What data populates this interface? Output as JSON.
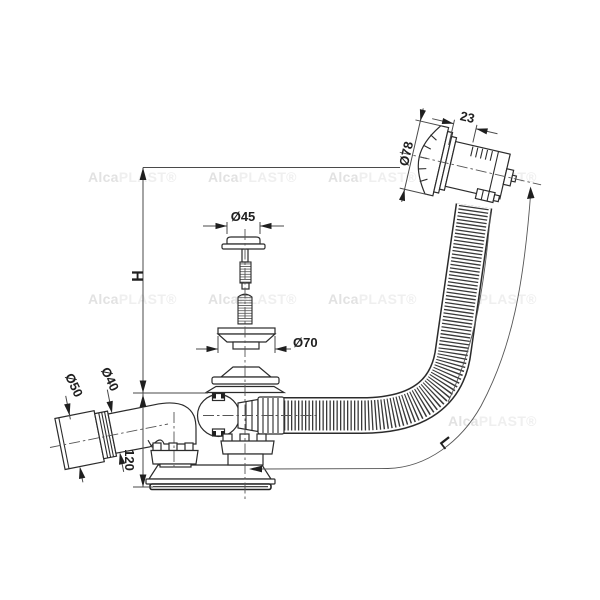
{
  "watermark": {
    "bold": "Alca",
    "light": "PLAST®"
  },
  "labels": {
    "head_depth": "23",
    "head_diameter": "Ø78",
    "plug_diameter": "Ø45",
    "flange_diameter": "Ø70",
    "sleeve_diameter": "Ø50",
    "pipe_diameter": "Ø40",
    "body_height": "120",
    "install_height": "H",
    "hose_length": "L"
  },
  "colors": {
    "background": "#ffffff",
    "part_line": "#2b2b2b",
    "dimension_line": "#4a4a4a",
    "watermark_bold": "#e2e2e2",
    "watermark_light": "#efefef"
  }
}
